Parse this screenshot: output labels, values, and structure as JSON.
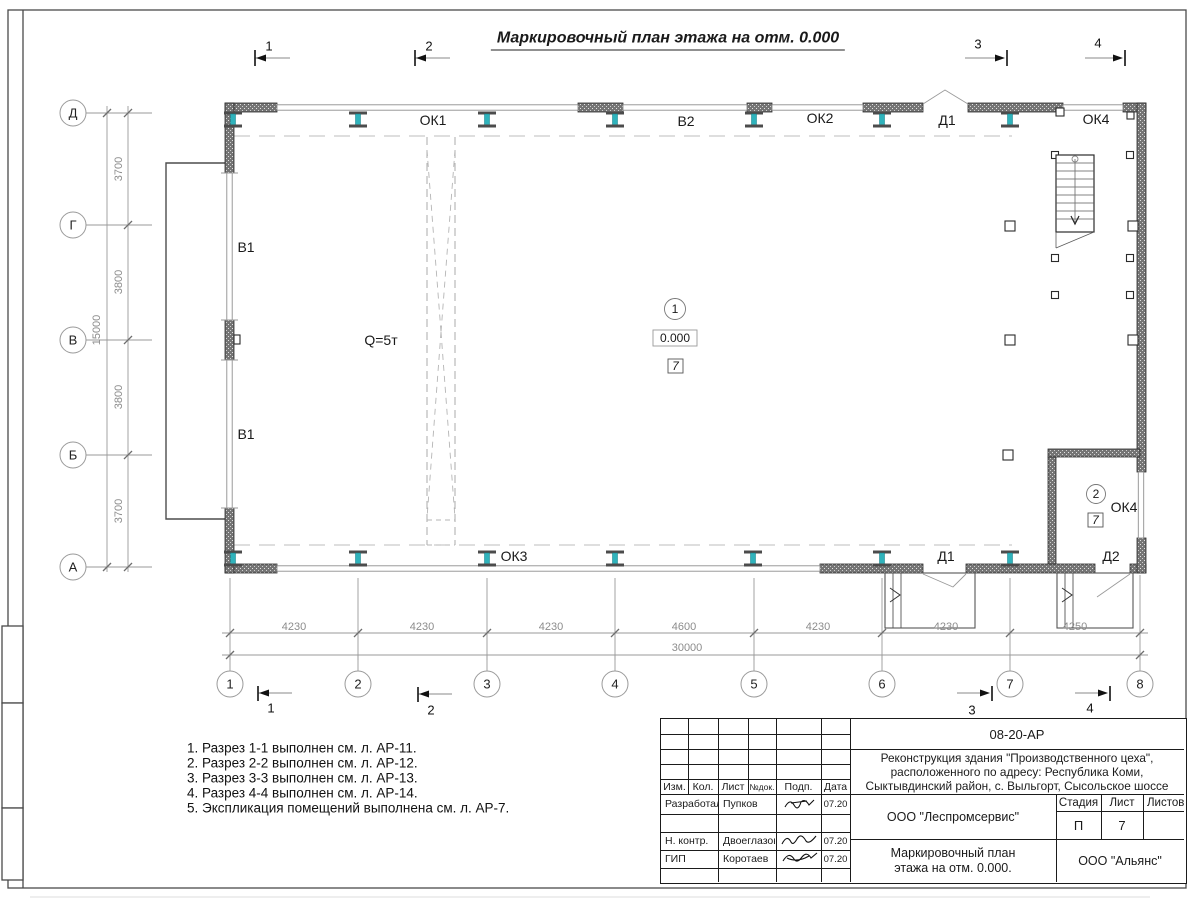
{
  "sheet_title": "Маркировочный план этажа на отм. 0.000",
  "plan": {
    "window_ok1": "ОК1",
    "window_v2": "В2",
    "window_ok2": "ОК2",
    "door_d1_top": "Д1",
    "window_ok4_top": "ОК4",
    "window_v1_upper": "В1",
    "window_v1_lower": "В1",
    "window_ok3": "ОК3",
    "door_d1_bottom": "Д1",
    "door_d2": "Д2",
    "window_ok4_room": "ОК4",
    "crane_capacity": "Q=5т",
    "room1": {
      "number": "1",
      "level": "0.000",
      "finish_tag": "7"
    },
    "room2": {
      "number": "2",
      "finish_tag": "7"
    }
  },
  "grid": {
    "row_axes": [
      "Д",
      "Г",
      "В",
      "Б",
      "А"
    ],
    "row_dims": [
      "3700",
      "3800",
      "3800",
      "3700"
    ],
    "row_total": "15000",
    "col_axes": [
      "1",
      "2",
      "3",
      "4",
      "5",
      "6",
      "7",
      "8"
    ],
    "col_dims": [
      "4230",
      "4230",
      "4230",
      "4600",
      "4230",
      "4230",
      "4250"
    ],
    "col_total": "30000"
  },
  "sections": {
    "s1": "1",
    "s2": "2",
    "s3": "3",
    "s4": "4"
  },
  "notes": [
    "1. Разрез 1-1 выполнен см. л. АР-11.",
    "2. Разрез 2-2 выполнен см. л. АР-12.",
    "3. Разрез 3-3 выполнен см. л. АР-13.",
    "4. Разрез 4-4 выполнен см. л. АР-14.",
    "5. Экспликация помещений выполнена см. л. АР-7."
  ],
  "titleblock": {
    "doc_number": "08-20-АР",
    "project_description": "Реконструкция здания \"Производственного цеха\", расположенного по адресу: Республика Коми, Сыктывдинский район, с. Выльгорт, Сысольское шоссе",
    "rev_header": {
      "izm": "Изм.",
      "kol": "Кол.",
      "list": "Лист",
      "ndok": "№док.",
      "podp": "Подп.",
      "data": "Дата"
    },
    "signature_rows": [
      {
        "role": "Разработал",
        "name": "Пупков",
        "date": "07.20"
      },
      {
        "role": "Н. контр.",
        "name": "Двоеглазов",
        "date": "07.20"
      },
      {
        "role": "ГИП",
        "name": "Коротаев",
        "date": "07.20"
      }
    ],
    "contractor": "ООО \"Леспромсервис\"",
    "stage_label": "Стадия",
    "sheet_label": "Лист",
    "sheets_label": "Листов",
    "stage": "П",
    "sheet_number": "7",
    "drawing_title": "Маркировочный план этажа на отм. 0.000.",
    "client": "ООО \"Альянс\""
  },
  "colors": {
    "steel_column_web": "#2fb3bc",
    "wall_fill": "#737373",
    "dim_text": "#8c8c8c"
  }
}
